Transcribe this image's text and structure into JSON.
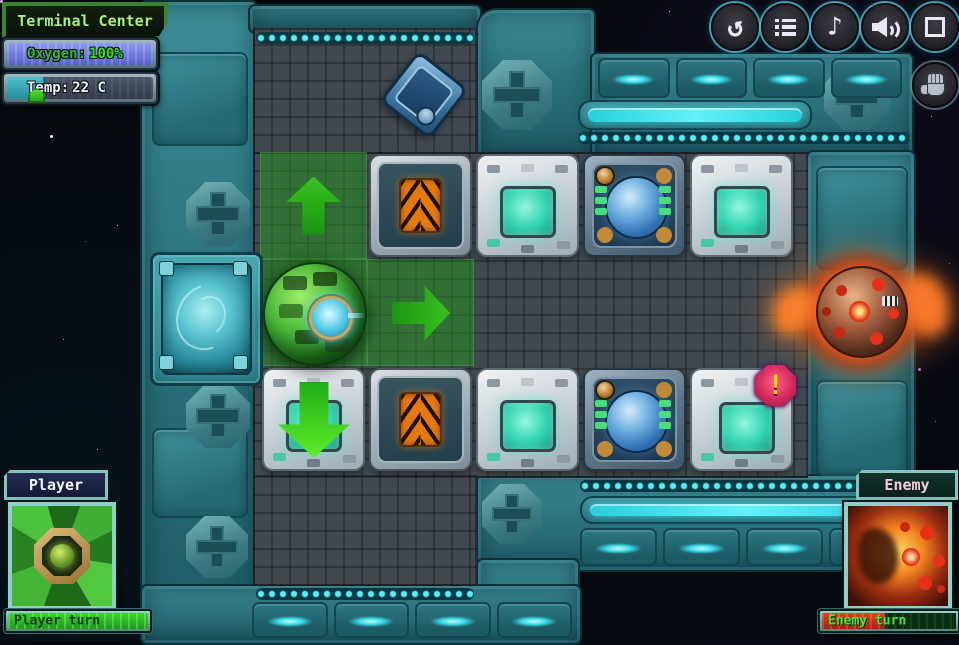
{
  "hud": {
    "title": "Terminal Center",
    "oxygen_label": "Oxygen:",
    "oxygen_value": "100%",
    "oxygen_pct": 100,
    "temp_label": "Temp:",
    "temp_value": "22 C",
    "temp_fill_pct": 26
  },
  "toolbar": {
    "buttons": [
      {
        "name": "restart",
        "icon": "restart-icon",
        "glyph": "↺"
      },
      {
        "name": "menu",
        "icon": "menu-list-icon"
      },
      {
        "name": "music",
        "icon": "music-note-icon",
        "glyph": "♪"
      },
      {
        "name": "sound",
        "icon": "speaker-icon"
      },
      {
        "name": "fullscreen",
        "icon": "fullscreen-icon"
      }
    ],
    "hand_tool": {
      "name": "hand",
      "icon": "hand-icon"
    }
  },
  "player_panel": {
    "title": "Player",
    "turn_label": "Player turn",
    "turn_fill_pct": 100
  },
  "enemy_panel": {
    "title": "Enemy",
    "turn_label": "Enemy turn",
    "turn_fill_pct": 47
  },
  "board": {
    "origin": {
      "x": 260,
      "y": 152
    },
    "cell_size": 107,
    "tiles": [
      {
        "type": "conveyor",
        "col": 1,
        "row": 0
      },
      {
        "type": "machine-screen",
        "col": 2,
        "row": 0
      },
      {
        "type": "orb-machine",
        "col": 3,
        "row": 0
      },
      {
        "type": "machine-screen",
        "col": 4,
        "row": 0
      },
      {
        "type": "machine-screen",
        "col": 0,
        "row": 2
      },
      {
        "type": "conveyor",
        "col": 1,
        "row": 2
      },
      {
        "type": "machine-screen",
        "col": 2,
        "row": 2
      },
      {
        "type": "orb-machine",
        "col": 3,
        "row": 2
      },
      {
        "type": "machine-alert",
        "col": 4,
        "row": 2
      }
    ],
    "highlight_cells": [
      {
        "col": 0,
        "row": 0
      },
      {
        "col": 0,
        "row": 1
      },
      {
        "col": 1,
        "row": 1
      }
    ],
    "move_arrows": [
      {
        "dir": "up",
        "col": 0,
        "row": 0
      },
      {
        "dir": "right",
        "col": 1,
        "row": 1
      },
      {
        "dir": "down",
        "col": 0,
        "row": 2
      }
    ],
    "alert_glyph": "!",
    "units": {
      "player_sphere": {
        "col": 0,
        "row": 1
      },
      "enemy_fireball": {
        "x": 800,
        "y": 254
      },
      "portal": {
        "x": 150,
        "y": 252
      },
      "crate": {
        "x": 392,
        "y": 63
      }
    }
  },
  "colors": {
    "wall_teal": "#2e7d87",
    "grid_gray": "#404950",
    "highlight_green": "#289421",
    "accent_cyan": "#35dfe8",
    "player_green": "#35c828",
    "enemy_orange": "#f07820",
    "oxygen_blue": "#5561c9",
    "alert_magenta": "#d42a5c"
  }
}
